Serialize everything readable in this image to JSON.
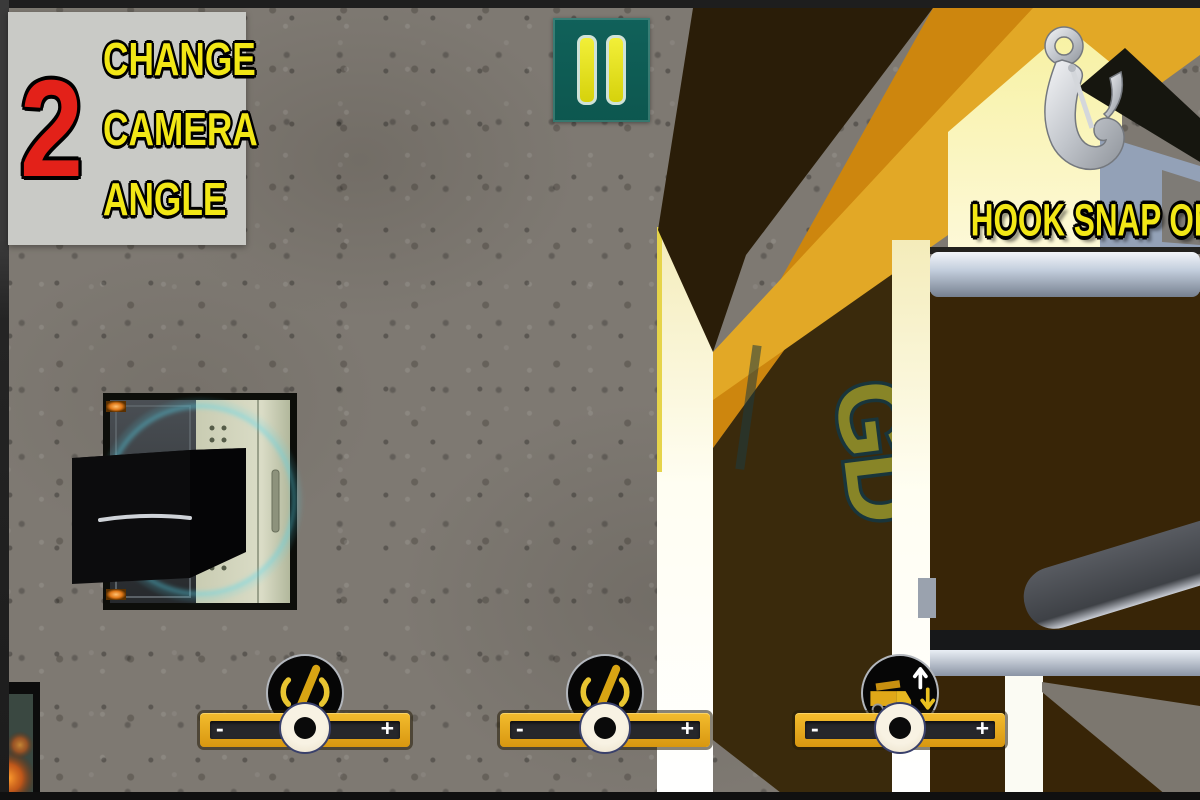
{
  "colors": {
    "accent_yellow": "#efb424",
    "hud_text_yellow": "#f2e716",
    "panel_gray": "#c9cac6",
    "number_red": "#e32119",
    "pause_teal": "#10615a",
    "boom_orange": "#d9950f",
    "boom_gold": "#e2a826",
    "cab_brown": "#3a2a0c",
    "steel_blue_gray": "#93a1b7",
    "glow_cyan": "#54d8ee"
  },
  "hud": {
    "camera_panel": {
      "number": "2",
      "lines": [
        "CHANGE",
        "CAMERA",
        "ANGLE"
      ]
    },
    "pause_button": {
      "icon": "pause-icon"
    },
    "hook_status": {
      "label": "HOOK SNAP ON",
      "icon": "crane-hook-icon"
    },
    "sliders": [
      {
        "id": "crane-slider-1",
        "icon": "mobile-crane-icon",
        "minus_label": "-",
        "plus_label": "+"
      },
      {
        "id": "crane-slider-2",
        "icon": "mobile-crane-icon",
        "minus_label": "-",
        "plus_label": "+"
      },
      {
        "id": "truck-slider",
        "icon": "truck-winch-icon",
        "minus_label": "-",
        "plus_label": "+"
      }
    ]
  },
  "scene": {
    "objects": [
      "concrete-floor",
      "crane-boom",
      "truck-cab",
      "cargo-box",
      "loading-platform",
      "hydraulic-cylinder",
      "crane-hook"
    ]
  }
}
